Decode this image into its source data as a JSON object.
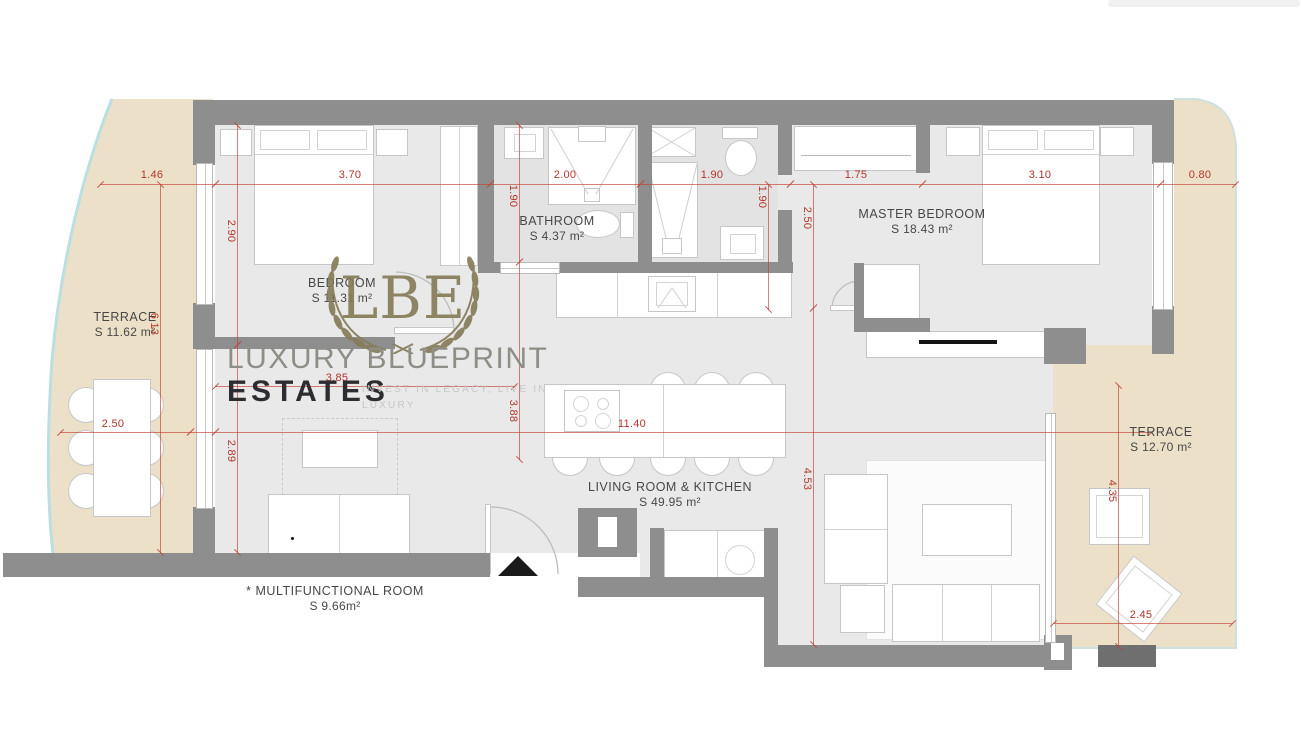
{
  "watermark": {
    "monogram": "LBE",
    "brand_line1": "LUXURY BLUEPRINT",
    "brand_line2": "ESTATES",
    "tagline_line1": "INVEST IN LEGACY, LIVE IN",
    "tagline_line2": "LUXURY"
  },
  "rooms": {
    "terrace_left": {
      "name": "TERRACE",
      "area": "S 11.62 m²"
    },
    "bedroom": {
      "name": "BEDROOM",
      "area": "S 11.31 m²"
    },
    "bathroom": {
      "name": "BATHROOM",
      "area": "S 4.37 m²"
    },
    "master_bedroom": {
      "name": "MASTER BEDROOM",
      "area": "S 18.43 m²"
    },
    "living_kitchen": {
      "name": "LIVING ROOM & KITCHEN",
      "area": "S 49.95 m²"
    },
    "terrace_right": {
      "name": "TERRACE",
      "area": "S 12.70 m²"
    },
    "multifunctional": {
      "name": "* MULTIFUNCTIONAL ROOM",
      "area": "S 9.66m²"
    }
  },
  "dimensions": {
    "top_row": {
      "t1": "1.46",
      "t2": "3.70",
      "t3": "2.00",
      "t4": "1.90",
      "t5": "1.75",
      "t6": "3.10",
      "t7": "0.80"
    },
    "vertical": {
      "v_bedroom": "2.90",
      "v_terrace": "6.13",
      "v_multi": "2.89",
      "v_bath": "1.90",
      "v_kitchen": "3.88",
      "v_wc": "1.90",
      "v_hall": "2.50",
      "v_living": "4.53",
      "v_terrace_r": "4.35"
    },
    "horizontal": {
      "h_table": "2.50",
      "h_total": "11.40",
      "h_multi": "3.85",
      "h_terrace_r": "2.45"
    }
  },
  "colors": {
    "wall": "#8e8e8e",
    "floor": "#e9e9e9",
    "terrace": "#ece1c8",
    "dimension": "#b5352b",
    "coast": "#b9dfe2",
    "watermark": "#867c58"
  }
}
